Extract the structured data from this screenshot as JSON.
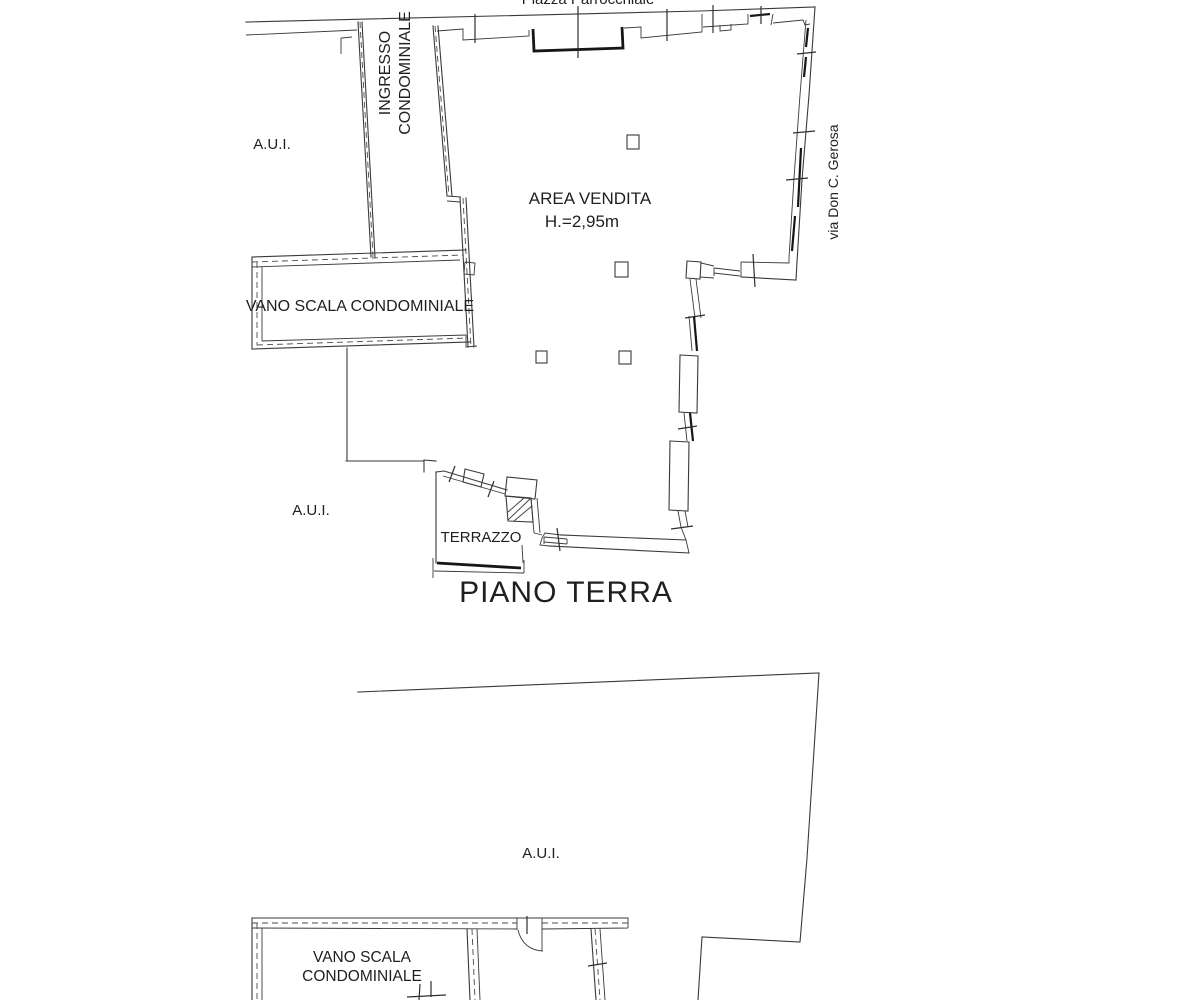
{
  "page": {
    "background": "#ffffff",
    "ink_color": "#3a3a3a",
    "kind": "scanned cadastral floor plan"
  },
  "top_plan": {
    "title": "PIANO TERRA",
    "street_top": "Piazza Parrocchiale",
    "street_right": "via Don C. Gerosa",
    "corridor": {
      "line1": "INGRESSO",
      "line2": "CONDOMINIALE"
    },
    "adjacent_top": "A.U.I.",
    "adjacent_bottom": "A.U.I.",
    "stairwell": "VANO SCALA CONDOMINIALE",
    "sales_area": {
      "name": "AREA VENDITA",
      "height": "H.=2,95m"
    },
    "terrace": "TERRAZZO"
  },
  "bottom_plan": {
    "adjacent": "A.U.I.",
    "stairwell": {
      "line1": "VANO SCALA",
      "line2": "CONDOMINIALE"
    }
  }
}
